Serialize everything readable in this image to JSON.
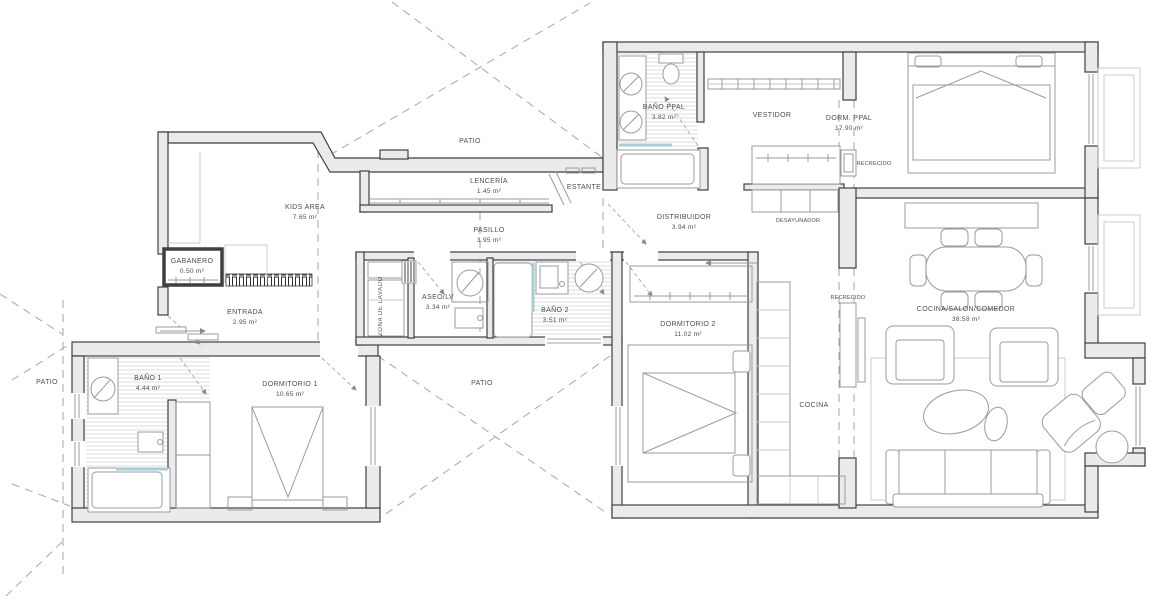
{
  "plan": {
    "rooms": [
      {
        "id": "kids-area",
        "label": "KIDS AREA",
        "area": "7.65 m²"
      },
      {
        "id": "patio-top",
        "label": "PATIO",
        "area": ""
      },
      {
        "id": "lenceria",
        "label": "LENCERÍA",
        "area": "1.45 m²"
      },
      {
        "id": "estante",
        "label": "ESTANTE",
        "area": ""
      },
      {
        "id": "bano-ppal",
        "label": "BAÑO PPAL",
        "area": "3.82 m²"
      },
      {
        "id": "vestidor",
        "label": "VESTIDOR",
        "area": ""
      },
      {
        "id": "dorm-ppal",
        "label": "DORM. PPAL",
        "area": "17.90 m²"
      },
      {
        "id": "recrecido-dorm",
        "label": "RECRECIDO",
        "area": ""
      },
      {
        "id": "distribuidor",
        "label": "DISTRIBUIDOR",
        "area": "3.94 m²"
      },
      {
        "id": "desayunador",
        "label": "DESAYUNADOR",
        "area": ""
      },
      {
        "id": "pasillo",
        "label": "PASILLO",
        "area": "3.95 m²"
      },
      {
        "id": "gabanero",
        "label": "GABANERO",
        "area": "0.50 m²"
      },
      {
        "id": "entrada",
        "label": "ENTRADA",
        "area": "2.95 m²"
      },
      {
        "id": "zona-lavado",
        "label": "ZONA DE LAVADO",
        "area": ""
      },
      {
        "id": "aseo-lv",
        "label": "ASEO/LV",
        "area": "3.34 m²"
      },
      {
        "id": "bano-2",
        "label": "BAÑO 2",
        "area": "3.51 m²"
      },
      {
        "id": "dormitorio-2",
        "label": "DORMITORIO 2",
        "area": "11.02 m²"
      },
      {
        "id": "recrecido-cocina",
        "label": "RECRECIDO",
        "area": ""
      },
      {
        "id": "cocina-salon",
        "label": "COCINA/SALON/COMEDOR",
        "area": "38.58 m²"
      },
      {
        "id": "cocina",
        "label": "COCINA",
        "area": ""
      },
      {
        "id": "patio-left",
        "label": "PATIO",
        "area": ""
      },
      {
        "id": "patio-mid",
        "label": "PATIO",
        "area": ""
      },
      {
        "id": "bano-1",
        "label": "BAÑO 1",
        "area": "4.44 m²"
      },
      {
        "id": "dormitorio-1",
        "label": "DORMITORIO 1",
        "area": "10.65 m²"
      }
    ],
    "colors": {
      "wall_fill": "#ebebeb",
      "wall_line": "#3f3f3f",
      "furniture_line": "#9b9b9b",
      "light_line": "#c9c9c9",
      "dash_line": "#a6a6a6",
      "glass_blue": "#a9cdd8",
      "hatch_line": "#dedede",
      "label_text": "#4d4d4d",
      "background": "#ffffff"
    }
  }
}
